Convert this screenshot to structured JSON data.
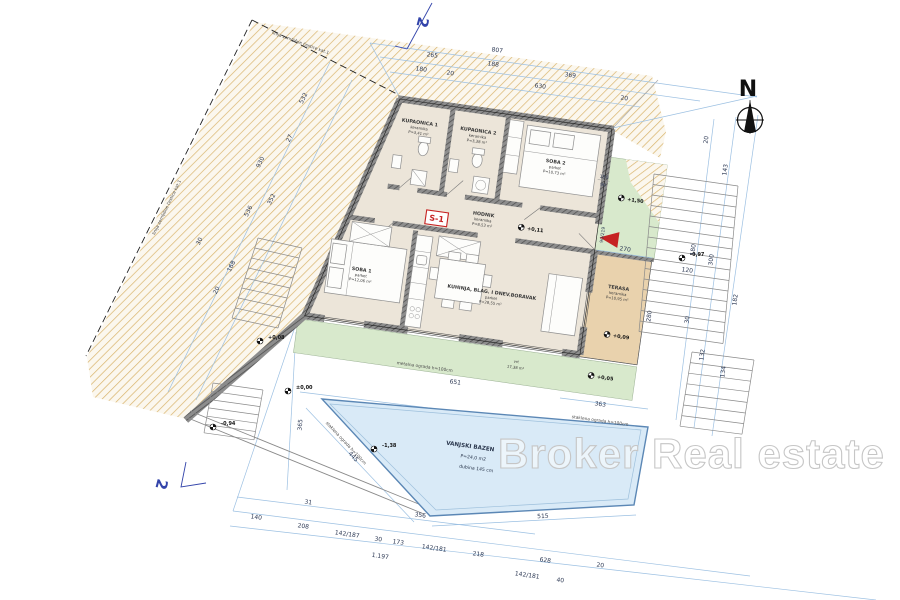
{
  "watermark": "Broker Real estate",
  "compass": {
    "label": "N"
  },
  "unit": {
    "label": "S-1"
  },
  "section": {
    "label": "2"
  },
  "rooms": {
    "kupaonica1": {
      "name": "KUPAONICA 1",
      "floor": "keramika",
      "area": "P=3,41 m²"
    },
    "kupaonica2": {
      "name": "KUPAONICA 2",
      "floor": "keramika",
      "area": "P=3,38 m²"
    },
    "soba2": {
      "name": "SOBA 2",
      "floor": "parket",
      "area": "P=10,73 m²"
    },
    "hodnik": {
      "name": "HODNIK",
      "floor": "keramika",
      "area": "P=8,53 m²"
    },
    "soba1": {
      "name": "SOBA 1",
      "floor": "parket",
      "area": "P=12,06 m²"
    },
    "dnevni": {
      "name": "KUHINJA, BLAG. I DNEV.BORAVAK",
      "floor": "parket",
      "area": "P=28,55 m²"
    },
    "terasa": {
      "name": "TERASA",
      "floor": "keramika",
      "area": "P=10,95 m²"
    },
    "vrt": {
      "name": "vrt",
      "area": "17,38 m²"
    },
    "bazen": {
      "name": "VANJSKI BAZEN",
      "area": "P=24,0 m2",
      "depth": "dubina 145 cm"
    }
  },
  "elevations": {
    "hodnik": "+0,11",
    "garden_upper": "+1,50",
    "stairs_right": "-0,97",
    "terasa": "+0,09",
    "vrt": "+0,05",
    "path_left": "+0,08",
    "entry": "±0,00",
    "lower_left": "-0,94",
    "pool": "-1,38"
  },
  "annotations": {
    "fence_metal": "metalna ograda h=100cm",
    "fence_glass": "staklena ograda h=100cm",
    "boundary": "linija zemljišne čestice kat.1",
    "door_right": "90/219"
  },
  "dimensions": {
    "top": [
      "807",
      "265",
      "188",
      "369",
      "180",
      "20",
      "630",
      "20"
    ],
    "right": [
      "20",
      "143",
      "300",
      "180",
      "182",
      "30",
      "132",
      "134"
    ],
    "left": [
      "532",
      "27",
      "352",
      "930",
      "536",
      "168",
      "30",
      "20"
    ],
    "bottom": [
      "31",
      "356",
      "140",
      "208",
      "142/187",
      "30",
      "173",
      "142/181",
      "218",
      "628",
      "20",
      "1.197",
      "142/181",
      "40"
    ],
    "site": [
      "651",
      "365",
      "363",
      "445",
      "515"
    ],
    "terrace": [
      "270",
      "280",
      "120"
    ],
    "garden": [
      "150",
      "90"
    ]
  },
  "colors": {
    "floor": "#ece5d9",
    "terrace": "#e9d2ad",
    "green": "#d8e9cc",
    "pool_fill": "#d9eaf7",
    "pool_stroke": "#5b87b5",
    "earth_hatch": "#d9b46c",
    "accent_red": "#c62222",
    "section_blue": "#3344aa"
  }
}
